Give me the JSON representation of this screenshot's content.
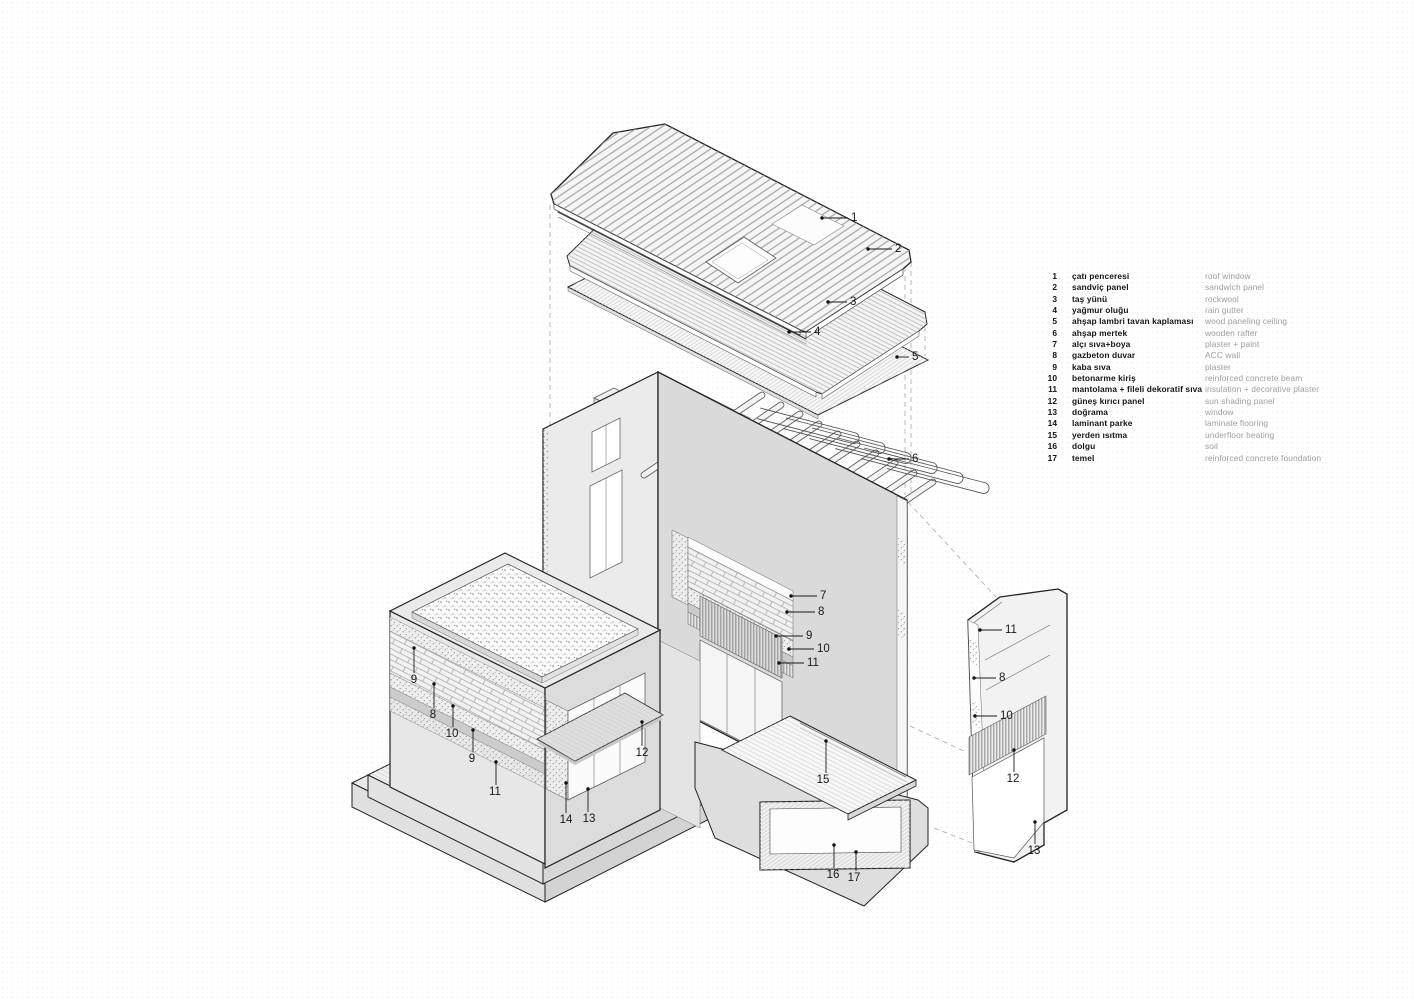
{
  "title": "exploded axonometric construction diagram",
  "colors": {
    "paper": "#ffffff",
    "ink": "#1c1c1c",
    "line_light": "#9a9a9a",
    "fill_light": "#efefef",
    "fill_mid": "#dedede",
    "fill_dark": "#d2d2d2",
    "legend_english": "#9e9e9e"
  },
  "legend": {
    "items": [
      {
        "n": "1",
        "tr": "çatı penceresi",
        "en": "roof window"
      },
      {
        "n": "2",
        "tr": "sandviç panel",
        "en": "sandwich panel"
      },
      {
        "n": "3",
        "tr": "taş yünü",
        "en": "rockwool"
      },
      {
        "n": "4",
        "tr": "yağmur oluğu",
        "en": "rain gutter"
      },
      {
        "n": "5",
        "tr": "ahşap lambri tavan kaplaması",
        "en": "wood paneling ceiling"
      },
      {
        "n": "6",
        "tr": "ahşap mertek",
        "en": "wooden rafter"
      },
      {
        "n": "7",
        "tr": "alçı sıva+boya",
        "en": "plaster + paint"
      },
      {
        "n": "8",
        "tr": "gazbeton duvar",
        "en": "ACC wall"
      },
      {
        "n": "9",
        "tr": "kaba sıva",
        "en": "plaster"
      },
      {
        "n": "10",
        "tr": "betonarme kiriş",
        "en": "reinforced concrete beam"
      },
      {
        "n": "11",
        "tr": "mantolama + fileli dekoratif sıva",
        "en": "insulation + decorative plaster"
      },
      {
        "n": "12",
        "tr": "güneş kırıcı panel",
        "en": "sun shading panel"
      },
      {
        "n": "13",
        "tr": "doğrama",
        "en": "window"
      },
      {
        "n": "14",
        "tr": "laminant parke",
        "en": "laminate flooring"
      },
      {
        "n": "15",
        "tr": "yerden ısıtma",
        "en": "underfloor heating"
      },
      {
        "n": "16",
        "tr": "dolgu",
        "en": "soil"
      },
      {
        "n": "17",
        "tr": "temel",
        "en": "reinforced concrete foundation"
      }
    ]
  },
  "callouts": [
    {
      "n": "1",
      "o": "h",
      "dx": 822,
      "dy": 218,
      "lx": 850,
      "ly": 218
    },
    {
      "n": "2",
      "o": "h",
      "dx": 868,
      "dy": 249,
      "lx": 894,
      "ly": 249
    },
    {
      "n": "3",
      "o": "h",
      "dx": 828,
      "dy": 302,
      "lx": 849,
      "ly": 300
    },
    {
      "n": "4",
      "o": "h",
      "dx": 789,
      "dy": 332,
      "lx": 813,
      "ly": 333
    },
    {
      "n": "5",
      "o": "h",
      "dx": 897,
      "dy": 357,
      "lx": 911,
      "ly": 360
    },
    {
      "n": "6",
      "o": "h",
      "dx": 889,
      "dy": 459,
      "lx": 911,
      "ly": 459
    },
    {
      "n": "7",
      "o": "h",
      "dx": 791,
      "dy": 596,
      "lx": 819,
      "ly": 595
    },
    {
      "n": "8",
      "o": "h",
      "dx": 787,
      "dy": 612,
      "lx": 817,
      "ly": 611
    },
    {
      "n": "9",
      "o": "h",
      "dx": 776,
      "dy": 636,
      "lx": 805,
      "ly": 636
    },
    {
      "n": "10",
      "o": "h",
      "dx": 789,
      "dy": 649,
      "lx": 816,
      "ly": 649
    },
    {
      "n": "11",
      "o": "h",
      "dx": 779,
      "dy": 663,
      "lx": 806,
      "ly": 662
    },
    {
      "n": "9",
      "o": "v",
      "dx": 414,
      "dy": 648,
      "lx": 414,
      "ly": 683
    },
    {
      "n": "8",
      "o": "v",
      "dx": 434,
      "dy": 684,
      "lx": 433,
      "ly": 718
    },
    {
      "n": "10",
      "o": "v",
      "dx": 453,
      "dy": 706,
      "lx": 452,
      "ly": 737
    },
    {
      "n": "9",
      "o": "v",
      "dx": 473,
      "dy": 730,
      "lx": 472,
      "ly": 762
    },
    {
      "n": "11",
      "o": "v",
      "dx": 496,
      "dy": 762,
      "lx": 495,
      "ly": 795
    },
    {
      "n": "12",
      "o": "v",
      "dx": 642,
      "dy": 722,
      "lx": 642,
      "ly": 756
    },
    {
      "n": "14",
      "o": "v",
      "dx": 566,
      "dy": 783,
      "lx": 566,
      "ly": 823
    },
    {
      "n": "13",
      "o": "v",
      "dx": 588,
      "dy": 789,
      "lx": 589,
      "ly": 822
    },
    {
      "n": "15",
      "o": "v",
      "dx": 826,
      "dy": 741,
      "lx": 823,
      "ly": 783
    },
    {
      "n": "16",
      "o": "v",
      "dx": 834,
      "dy": 845,
      "lx": 833,
      "ly": 878
    },
    {
      "n": "17",
      "o": "v",
      "dx": 856,
      "dy": 852,
      "lx": 854,
      "ly": 881
    },
    {
      "n": "11",
      "o": "h",
      "dx": 980,
      "dy": 630,
      "lx": 1004,
      "ly": 629
    },
    {
      "n": "8",
      "o": "h",
      "dx": 974,
      "dy": 678,
      "lx": 998,
      "ly": 678
    },
    {
      "n": "10",
      "o": "h",
      "dx": 975,
      "dy": 716,
      "lx": 999,
      "ly": 716
    },
    {
      "n": "12",
      "o": "v",
      "dx": 1014,
      "dy": 750,
      "lx": 1013,
      "ly": 782
    },
    {
      "n": "13",
      "o": "v",
      "dx": 1035,
      "dy": 822,
      "lx": 1034,
      "ly": 854
    }
  ]
}
